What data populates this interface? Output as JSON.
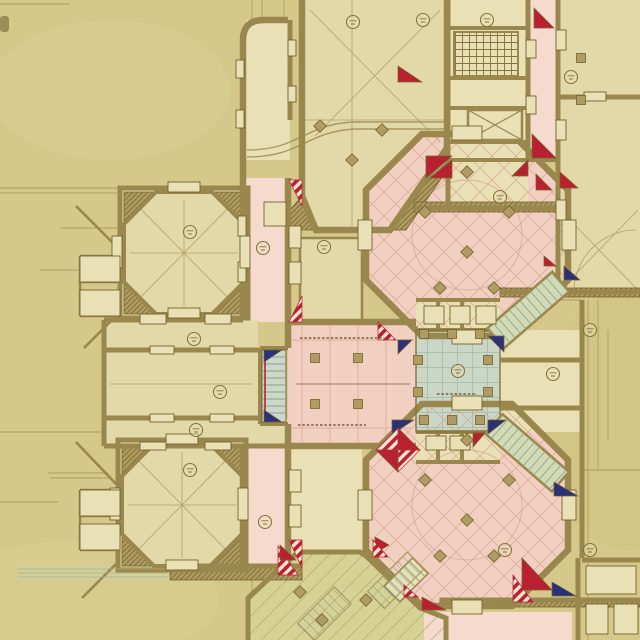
{
  "drawing": {
    "kind": "hand-drawn architectural floor plan, ink and colored wash on toned paper",
    "visible_text_legible": false,
    "room_number_badges_count": 18
  },
  "palette": {
    "paper": "#d5c88a",
    "paper_light": "#e0d59f",
    "paper_dark": "#c3b473",
    "room": "#e3d8a8",
    "room_light": "#eae0b6",
    "wall": "#9a874d",
    "wall_dark": "#73632e",
    "hatch_bg": "#b09c62",
    "hatch_line": "#857238",
    "pink": "#f1cfc1",
    "pink_pale": "#f5dacd",
    "pink_line": "#d8a997",
    "blue": "#c9d6c8",
    "blue_line": "#a3b8a1",
    "green": "#d6d295",
    "green_line": "#b5b072",
    "gallery": "#d3dab6",
    "tread": "#87a287",
    "tread_bg": "#ccd8cb",
    "red": "#ba2130",
    "navy": "#2c3078",
    "faint": "#a6935a",
    "label": "#85743a",
    "annot": "#7b6848"
  },
  "markers": [
    {
      "cx": 353,
      "cy": 22
    },
    {
      "cx": 423,
      "cy": 20
    },
    {
      "cx": 487,
      "cy": 20
    },
    {
      "cx": 571,
      "cy": 77
    },
    {
      "cx": 500,
      "cy": 197
    },
    {
      "cx": 190,
      "cy": 232
    },
    {
      "cx": 263,
      "cy": 248
    },
    {
      "cx": 324,
      "cy": 247
    },
    {
      "cx": 194,
      "cy": 339
    },
    {
      "cx": 220,
      "cy": 392
    },
    {
      "cx": 196,
      "cy": 430
    },
    {
      "cx": 458,
      "cy": 371
    },
    {
      "cx": 553,
      "cy": 374
    },
    {
      "cx": 590,
      "cy": 330
    },
    {
      "cx": 190,
      "cy": 470
    },
    {
      "cx": 265,
      "cy": 522
    },
    {
      "cx": 505,
      "cy": 550
    },
    {
      "cx": 590,
      "cy": 550
    }
  ],
  "triangles": [
    {
      "pts": "289,180 302,180 302,206",
      "fill": "striped"
    },
    {
      "pts": "289,322 302,322 302,296",
      "fill": "striped"
    },
    {
      "pts": "289,540 302,540 302,568",
      "fill": "striped"
    },
    {
      "pts": "426,156 452,156 426,178",
      "fill": "red"
    },
    {
      "pts": "430,178 452,160 452,178",
      "fill": "red"
    },
    {
      "pts": "398,66 422,82 398,82",
      "fill": "red"
    },
    {
      "pts": "534,8 554,28 534,28",
      "fill": "red"
    },
    {
      "pts": "532,134 556,158 532,158",
      "fill": "red"
    },
    {
      "pts": "528,160 512,176 528,176",
      "fill": "red"
    },
    {
      "pts": "536,174 552,190 536,190",
      "fill": "red"
    },
    {
      "pts": "560,172 578,188 560,188",
      "fill": "red"
    },
    {
      "pts": "544,256 556,266 544,266",
      "fill": "red"
    },
    {
      "pts": "564,266 580,280 564,280",
      "fill": "navy"
    },
    {
      "pts": "378,322 396,340 378,340",
      "fill": "striped"
    },
    {
      "pts": "398,340 412,340 398,354",
      "fill": "navy"
    },
    {
      "pts": "488,336 504,336 504,352",
      "fill": "navy"
    },
    {
      "pts": "392,420 414,420 392,434",
      "fill": "navy"
    },
    {
      "pts": "488,420 506,420 488,434",
      "fill": "navy"
    },
    {
      "pts": "473,433 485,433 473,447",
      "fill": "red"
    },
    {
      "pts": "554,482 578,496 554,496",
      "fill": "navy"
    },
    {
      "pts": "375,537 389,545 375,553",
      "fill": "red"
    },
    {
      "pts": "422,597 446,610 422,610",
      "fill": "red"
    },
    {
      "pts": "404,585 418,597 404,597",
      "fill": "striped"
    },
    {
      "pts": "522,558 552,590 522,590",
      "fill": "red"
    },
    {
      "pts": "552,582 576,596 552,596",
      "fill": "navy"
    },
    {
      "pts": "513,575 533,602 513,602",
      "fill": "striped"
    },
    {
      "pts": "278,546 298,575 278,575",
      "fill": "striped"
    },
    {
      "pts": "280,545 296,560 280,560",
      "fill": "red"
    },
    {
      "pts": "373,540 388,557 373,557",
      "fill": "striped"
    },
    {
      "pts": "264,350 282,350 264,362",
      "fill": "navy"
    },
    {
      "pts": "264,422 282,422 264,410",
      "fill": "navy"
    },
    {
      "pts": "398,428 420,450 398,450",
      "fill": "red"
    },
    {
      "pts": "420,450 398,472 398,450",
      "fill": "striped"
    },
    {
      "pts": "398,472 376,450 398,450",
      "fill": "red"
    },
    {
      "pts": "376,450 398,428 398,450",
      "fill": "striped"
    }
  ],
  "diamonds": [
    [
      320,
      126
    ],
    [
      382,
      130
    ],
    [
      352,
      160
    ],
    [
      467,
      172
    ],
    [
      425,
      212
    ],
    [
      509,
      212
    ],
    [
      467,
      252
    ],
    [
      440,
      288
    ],
    [
      494,
      288
    ],
    [
      467,
      440
    ],
    [
      425,
      480
    ],
    [
      509,
      480
    ],
    [
      467,
      520
    ],
    [
      440,
      556
    ],
    [
      494,
      556
    ],
    [
      322,
      620
    ],
    [
      366,
      600
    ],
    [
      300,
      592
    ]
  ],
  "squares": [
    [
      581,
      58
    ],
    [
      581,
      100
    ],
    [
      424,
      334
    ],
    [
      452,
      334
    ],
    [
      480,
      334
    ],
    [
      424,
      420
    ],
    [
      452,
      420
    ],
    [
      480,
      420
    ],
    [
      418,
      360
    ],
    [
      418,
      392
    ],
    [
      488,
      360
    ],
    [
      488,
      392
    ],
    [
      315,
      358
    ],
    [
      358,
      358
    ],
    [
      315,
      404
    ],
    [
      358,
      404
    ]
  ],
  "niches": [
    [
      236,
      60,
      8,
      18
    ],
    [
      236,
      110,
      8,
      18
    ],
    [
      288,
      40,
      8,
      16
    ],
    [
      288,
      86,
      8,
      16
    ],
    [
      238,
      216,
      8,
      20
    ],
    [
      238,
      262,
      8,
      20
    ],
    [
      289,
      226,
      12,
      22
    ],
    [
      289,
      262,
      12,
      22
    ],
    [
      264,
      202,
      22,
      24
    ],
    [
      140,
      314,
      26,
      10
    ],
    [
      205,
      314,
      26,
      10
    ],
    [
      150,
      346,
      24,
      8
    ],
    [
      210,
      346,
      24,
      8
    ],
    [
      150,
      414,
      24,
      8
    ],
    [
      210,
      414,
      24,
      8
    ],
    [
      140,
      442,
      26,
      8
    ],
    [
      205,
      442,
      26,
      8
    ],
    [
      452,
      126,
      30,
      14
    ],
    [
      452,
      330,
      30,
      14
    ],
    [
      358,
      220,
      14,
      30
    ],
    [
      562,
      220,
      14,
      30
    ],
    [
      452,
      396,
      30,
      14
    ],
    [
      452,
      600,
      30,
      14
    ],
    [
      358,
      490,
      14,
      30
    ],
    [
      562,
      490,
      14,
      30
    ],
    [
      168,
      182,
      32,
      10
    ],
    [
      168,
      308,
      32,
      10
    ],
    [
      112,
      236,
      10,
      32
    ],
    [
      240,
      236,
      10,
      32
    ],
    [
      166,
      434,
      32,
      10
    ],
    [
      166,
      560,
      32,
      10
    ],
    [
      110,
      488,
      10,
      32
    ],
    [
      238,
      488,
      10,
      32
    ],
    [
      424,
      306,
      20,
      18
    ],
    [
      450,
      306,
      20,
      18
    ],
    [
      476,
      306,
      20,
      18
    ],
    [
      426,
      436,
      20,
      14
    ],
    [
      450,
      436,
      20,
      14
    ],
    [
      556,
      30,
      10,
      20
    ],
    [
      556,
      120,
      10,
      20
    ],
    [
      556,
      200,
      10,
      20
    ],
    [
      584,
      92,
      22,
      9
    ],
    [
      586,
      566,
      50,
      28
    ],
    [
      586,
      604,
      22,
      30
    ],
    [
      614,
      604,
      24,
      30
    ],
    [
      289,
      470,
      12,
      22
    ],
    [
      289,
      505,
      12,
      22
    ],
    [
      526,
      40,
      10,
      18
    ],
    [
      526,
      96,
      10,
      18
    ],
    [
      80,
      256,
      40,
      26
    ],
    [
      80,
      290,
      40,
      26
    ],
    [
      80,
      490,
      40,
      26
    ],
    [
      80,
      524,
      40,
      26
    ]
  ],
  "construction_lines": [
    [
      0,
      4,
      70,
      4
    ],
    [
      0,
      188,
      130,
      188
    ],
    [
      0,
      193,
      118,
      193
    ],
    [
      60,
      228,
      118,
      228
    ],
    [
      40,
      270,
      96,
      270
    ],
    [
      0,
      432,
      104,
      432
    ],
    [
      48,
      473,
      108,
      473
    ],
    [
      50,
      478,
      108,
      478
    ],
    [
      0,
      502,
      58,
      502
    ],
    [
      252,
      0,
      252,
      20
    ],
    [
      262,
      0,
      262,
      20
    ],
    [
      284,
      0,
      284,
      20
    ],
    [
      577,
      25,
      640,
      25
    ],
    [
      577,
      37,
      640,
      37
    ],
    [
      598,
      90,
      640,
      72
    ],
    [
      588,
      300,
      588,
      640
    ],
    [
      598,
      300,
      598,
      470
    ],
    [
      608,
      330,
      608,
      440
    ],
    [
      584,
      470,
      640,
      470
    ],
    [
      252,
      578,
      252,
      640
    ],
    [
      20,
      568,
      60,
      568
    ],
    [
      566,
      57,
      640,
      57
    ],
    [
      520,
      300,
      582,
      300
    ]
  ],
  "annotations": [
    {
      "x": 300,
      "y": 338,
      "w": 84
    },
    {
      "x": 298,
      "y": 425,
      "w": 68
    },
    {
      "x": 437,
      "y": 394,
      "w": 40
    }
  ]
}
